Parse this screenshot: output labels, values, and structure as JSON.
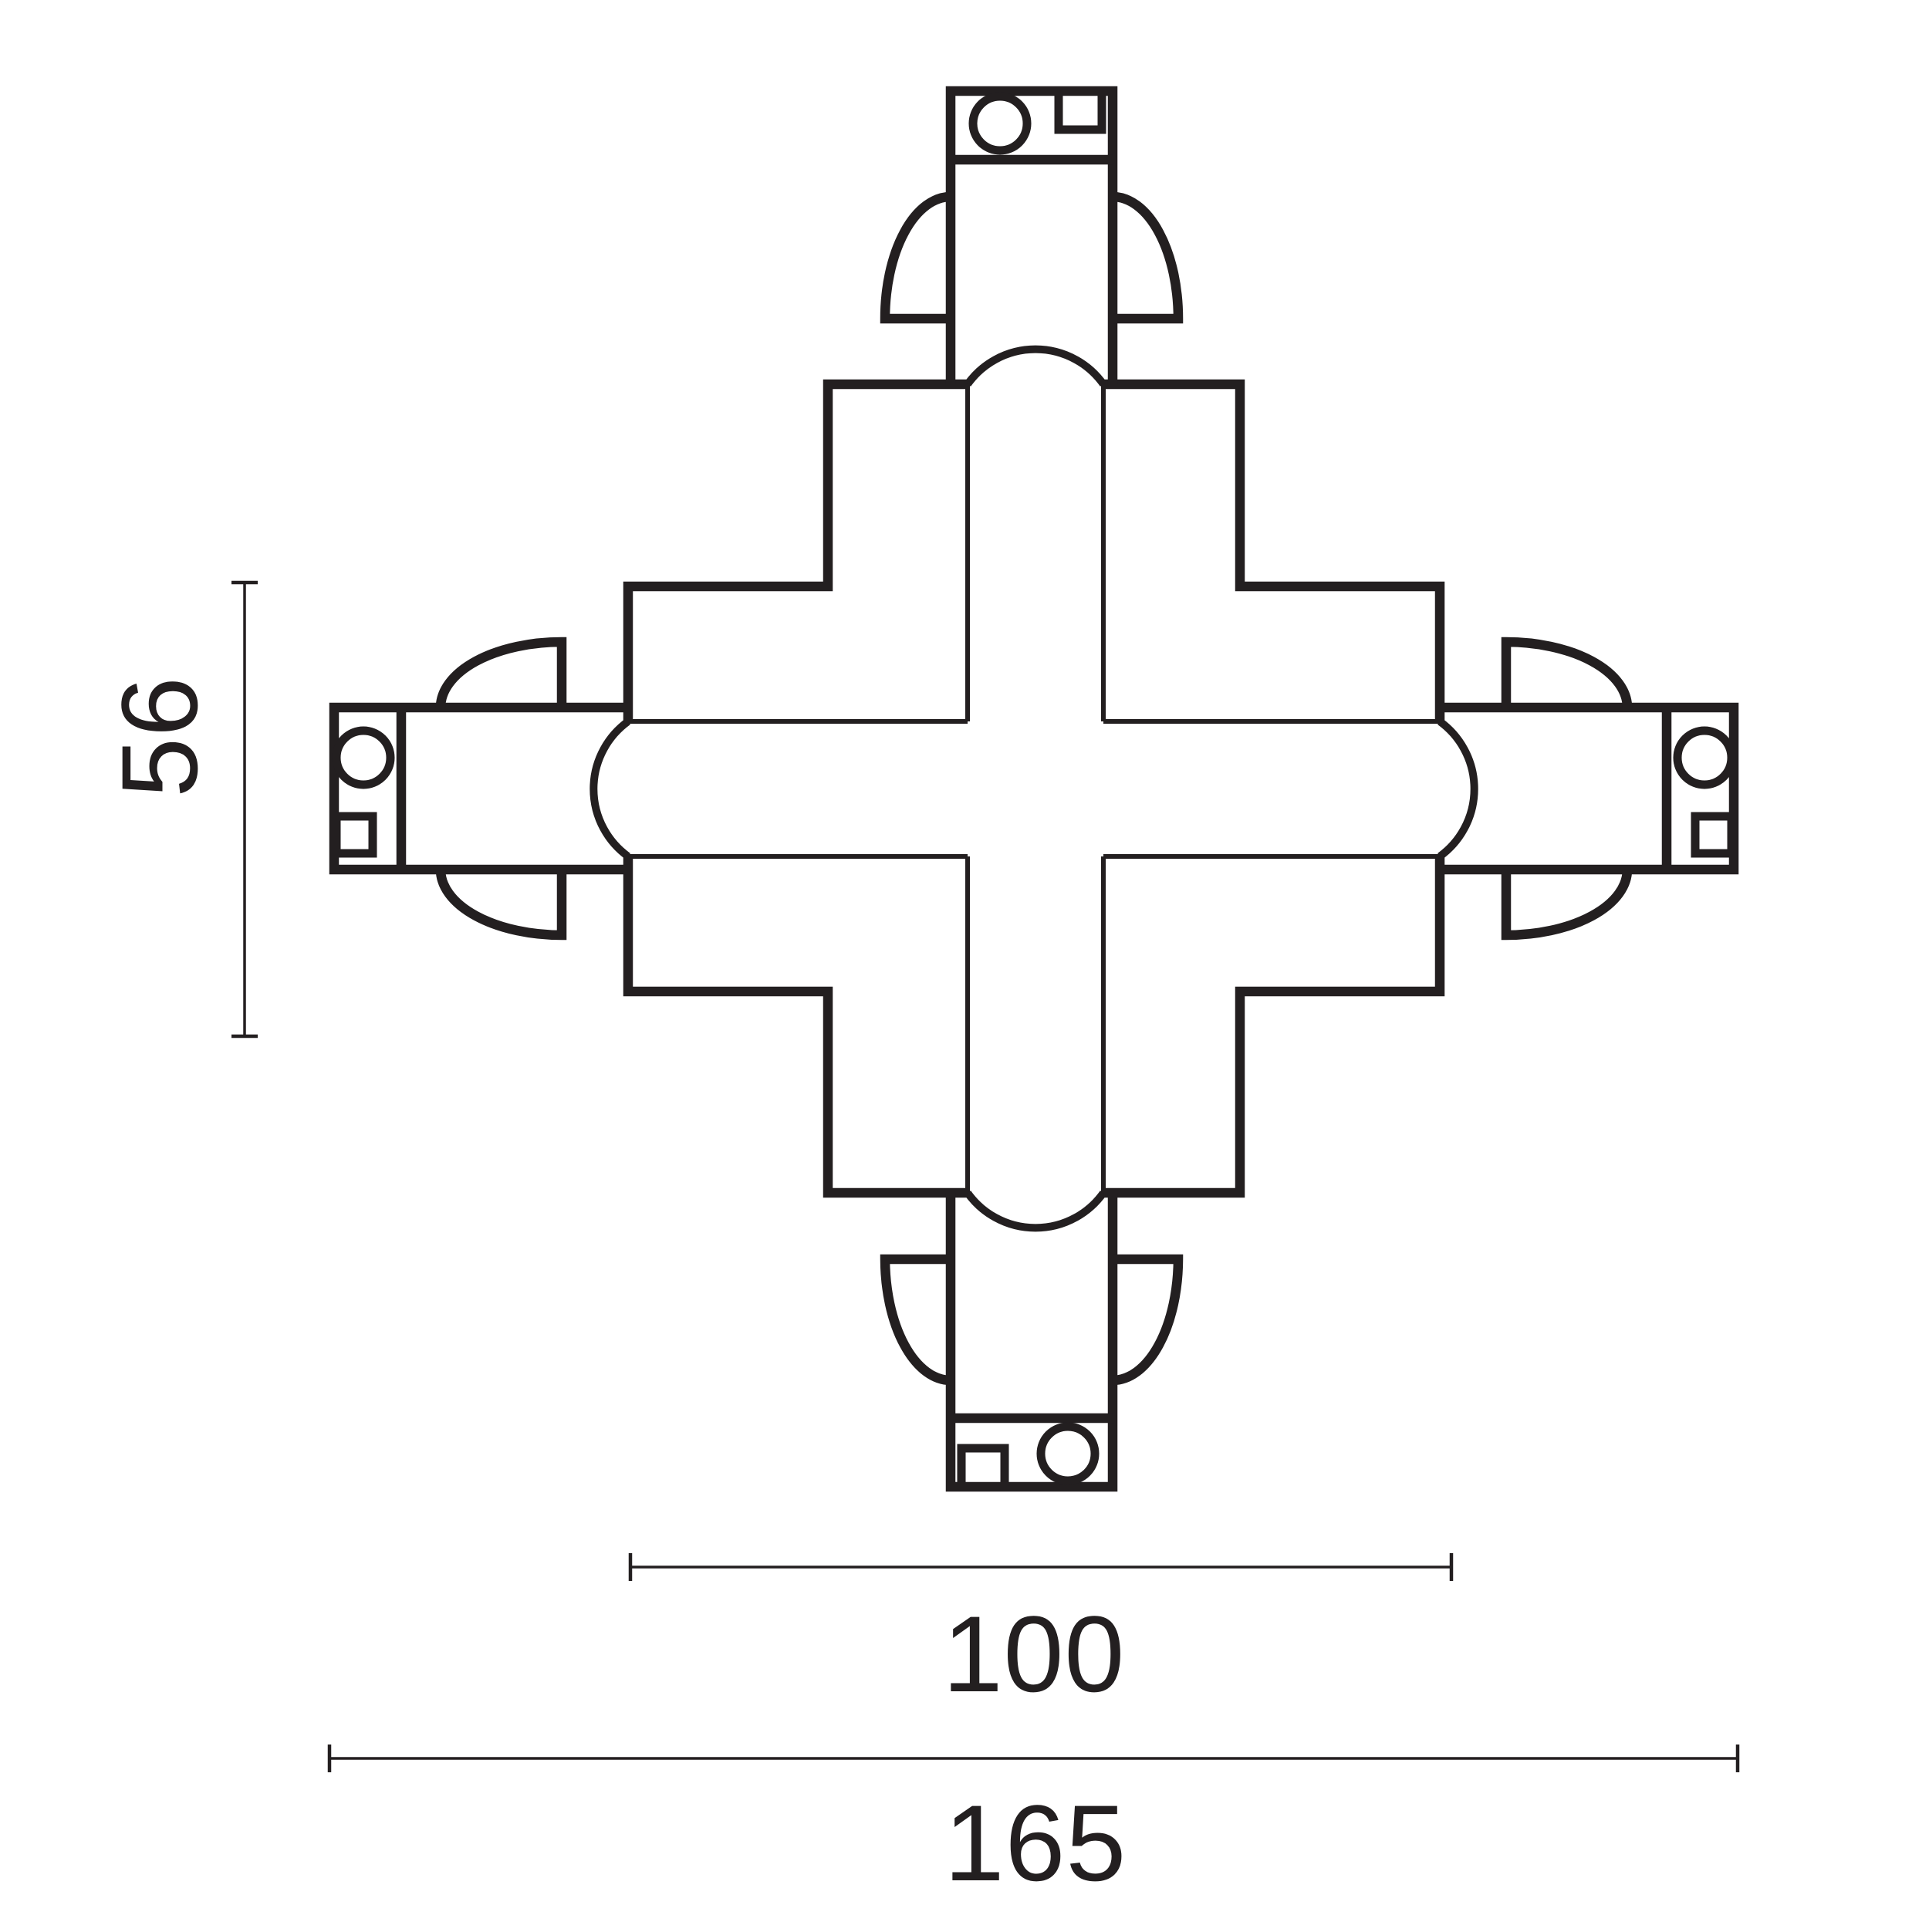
{
  "colors": {
    "ink": "#231f20",
    "background": "#ffffff"
  },
  "drawing": {
    "type": "technical-dimension-drawing",
    "dimensions": {
      "side": {
        "label": "56",
        "orientation": "vertical",
        "position": "left"
      },
      "inner": {
        "label": "100",
        "orientation": "horizontal",
        "position": "bottom"
      },
      "overall": {
        "label": "165",
        "orientation": "horizontal",
        "position": "bottom"
      }
    }
  }
}
